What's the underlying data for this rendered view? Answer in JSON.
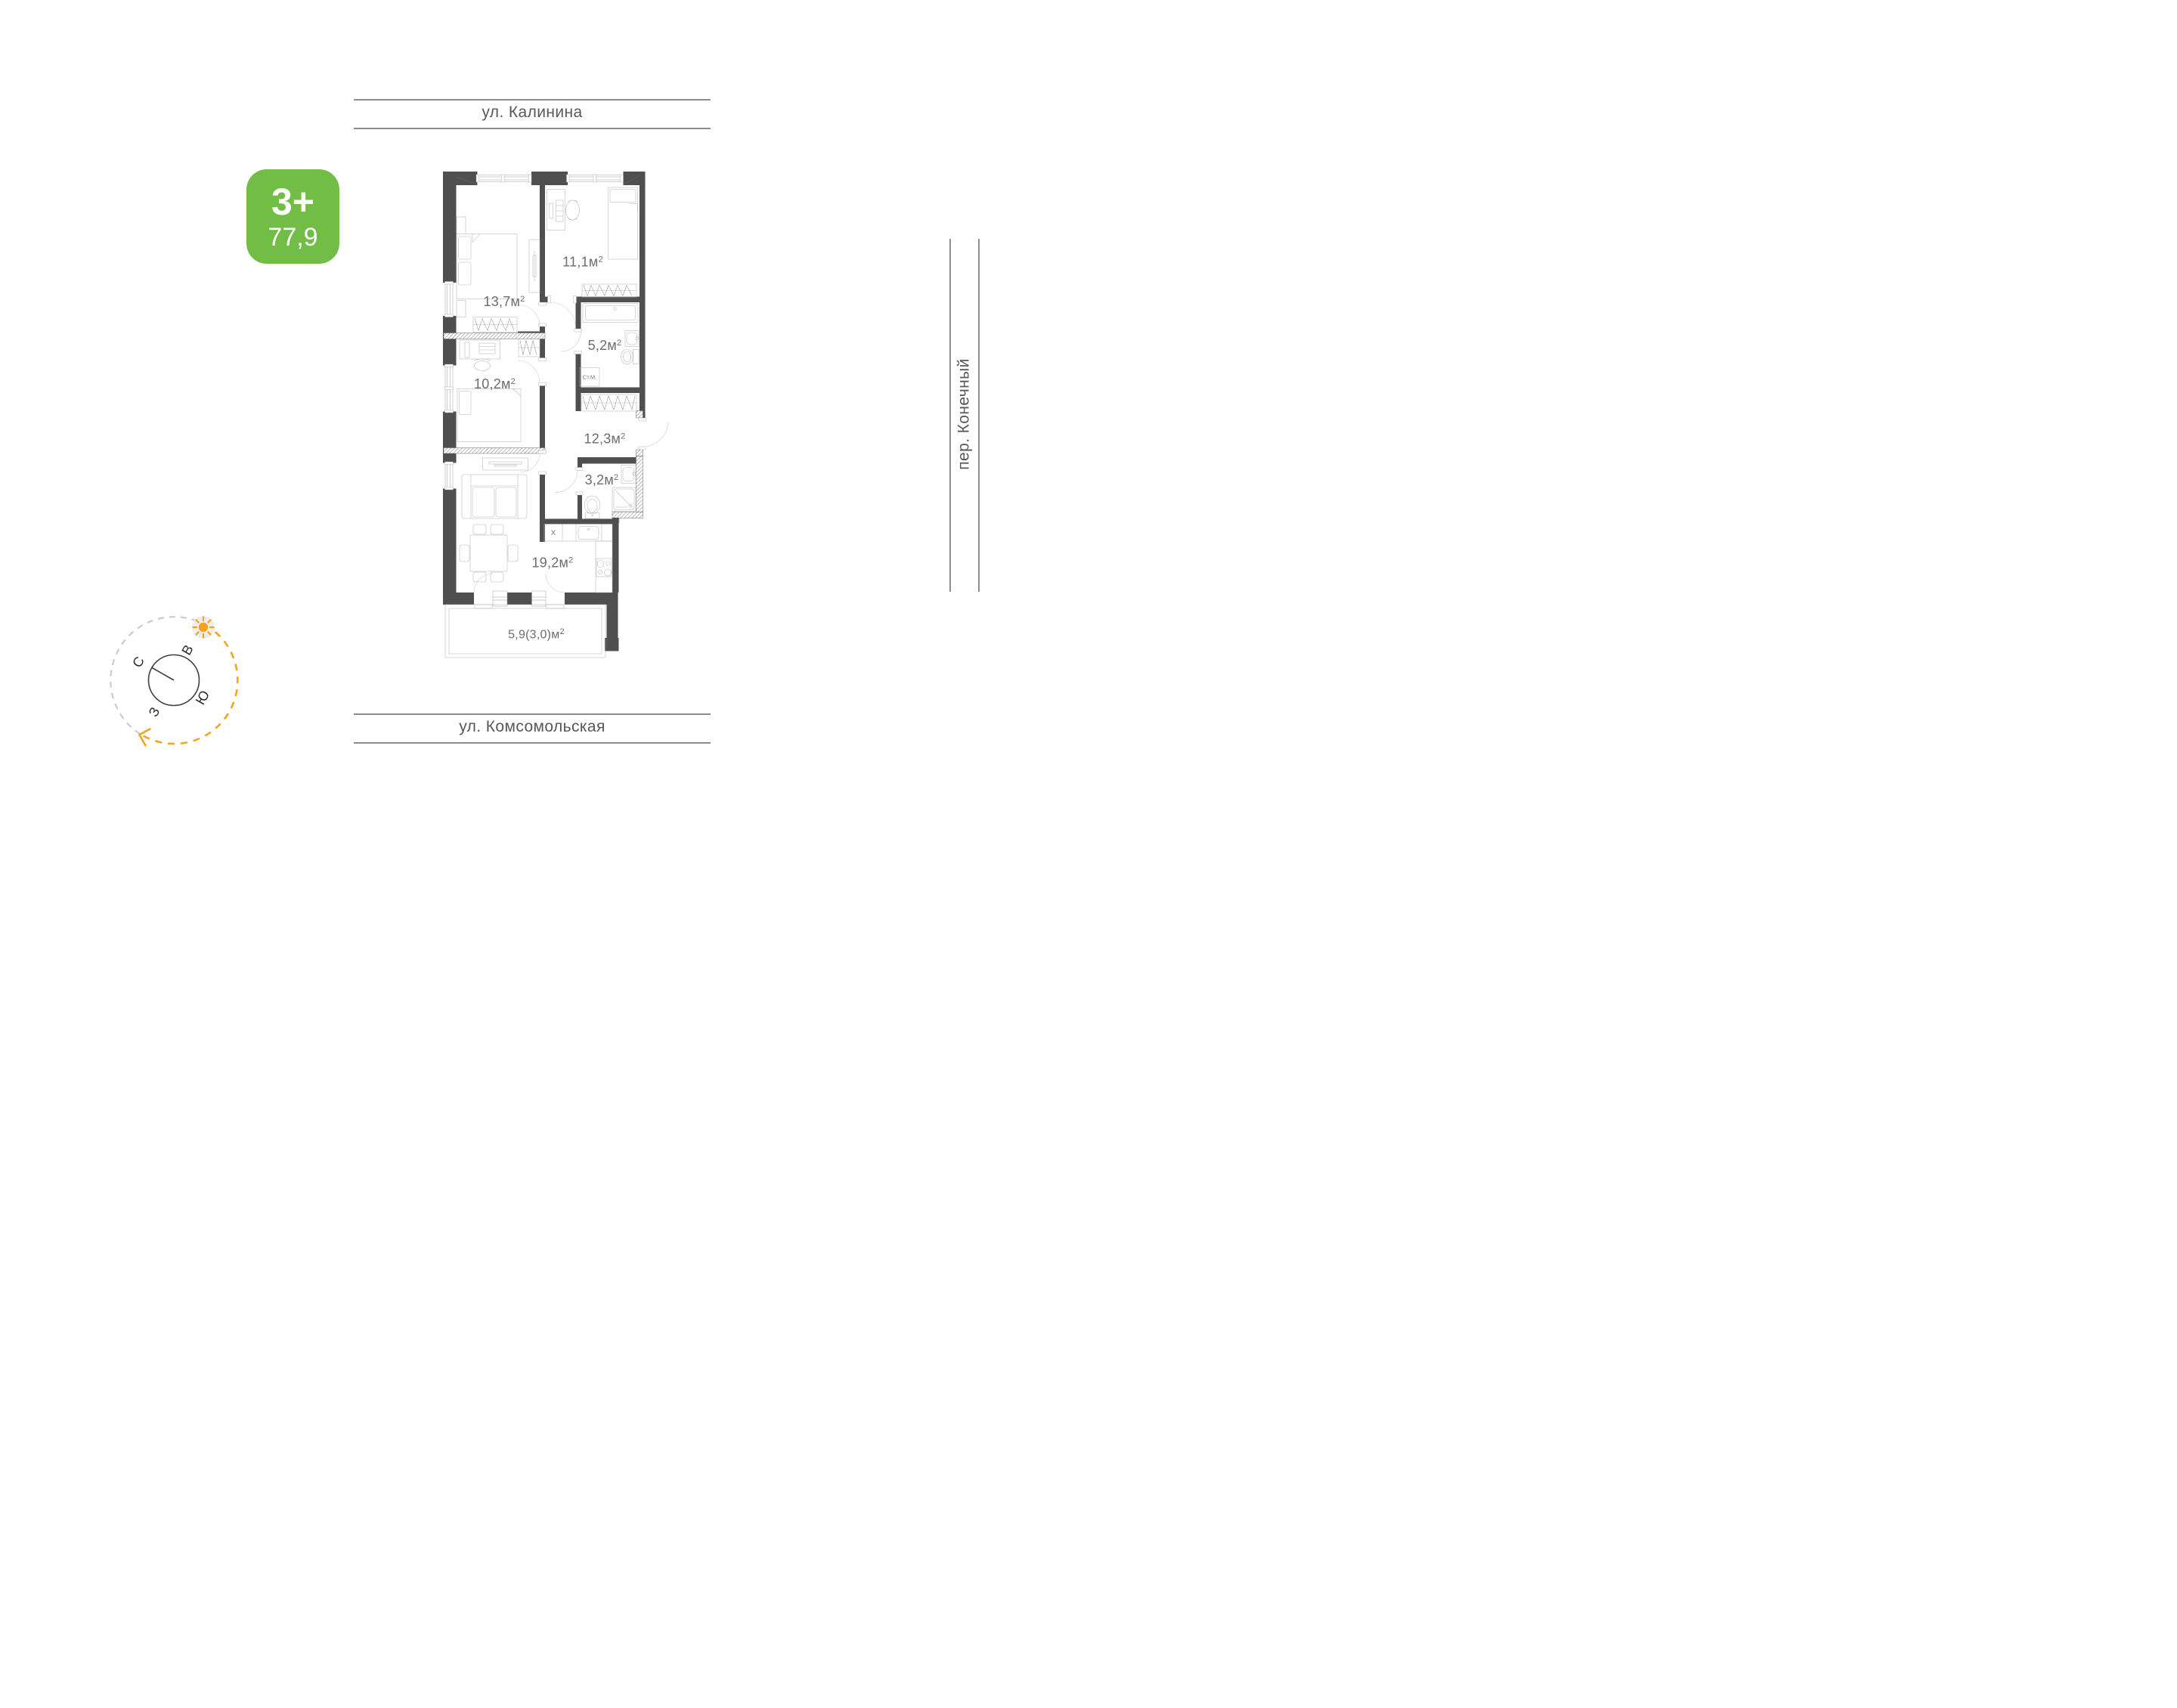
{
  "streets": {
    "top": "ул. Калинина",
    "right": "пер. Конечный",
    "bottom": "ул. Комсомольская"
  },
  "badge": {
    "rooms_label": "3+",
    "total_area": "77,9"
  },
  "plan": {
    "rooms": [
      {
        "id": "bedroom-1",
        "area": "13,7",
        "unit": "м",
        "sup": "2"
      },
      {
        "id": "bedroom-2",
        "area": "11,1",
        "unit": "м",
        "sup": "2"
      },
      {
        "id": "bathroom",
        "area": "5,2",
        "unit": "м",
        "sup": "2"
      },
      {
        "id": "bedroom-3",
        "area": "10,2",
        "unit": "м",
        "sup": "2"
      },
      {
        "id": "hallway",
        "area": "12,3",
        "unit": "м",
        "sup": "2"
      },
      {
        "id": "wc",
        "area": "3,2",
        "unit": "м",
        "sup": "2"
      },
      {
        "id": "kitchen-living",
        "area": "19,2",
        "unit": "м",
        "sup": "2"
      },
      {
        "id": "balcony",
        "area": "5,9(3,0)",
        "unit": "м",
        "sup": "2"
      }
    ],
    "labels": {
      "washing_machine": "Ст.М.",
      "fridge": "X"
    }
  },
  "compass": {
    "north": "С",
    "east": "В",
    "south": "Ю",
    "west": "З"
  },
  "colors": {
    "badge_green": "#71bd45",
    "compass_orange": "#F6A21E",
    "wall_gray": "#4f4f4f",
    "street_line_gray": "#8d8d8d"
  }
}
